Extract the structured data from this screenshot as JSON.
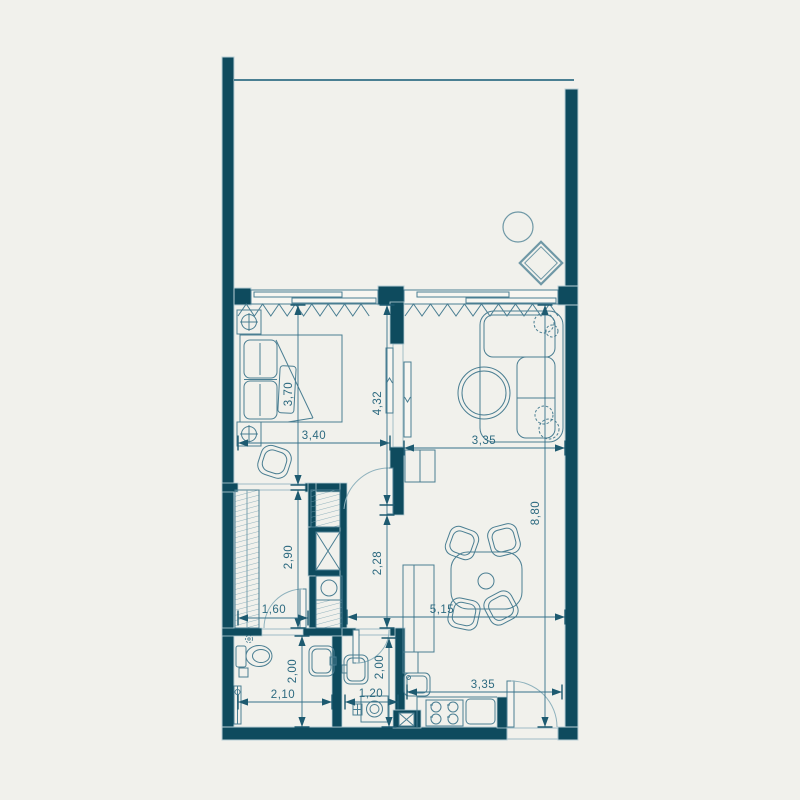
{
  "plan": {
    "type": "apartment-floor-plan",
    "colors": {
      "wall": "#0e4b5e",
      "wall_halo": "#b9cfd6",
      "furniture_line": "#4a7e92",
      "dimension": "#2d6a80",
      "background": "#f1f1ec"
    },
    "dimensions": {
      "bedroom_length": "3,70",
      "bedroom_width": "3,40",
      "bedroom_wall": "4,32",
      "living_width": "3,35",
      "living_length": "8,80",
      "corridor_length": "2,90",
      "entry_length": "2,28",
      "corridor_width": "1,60",
      "dining_width": "5,15",
      "bathroom_length": "2,00",
      "bathroom_width": "2,10",
      "laundry_width": "1,20",
      "laundry_length": "2,00",
      "kitchen_width": "3,35"
    }
  }
}
